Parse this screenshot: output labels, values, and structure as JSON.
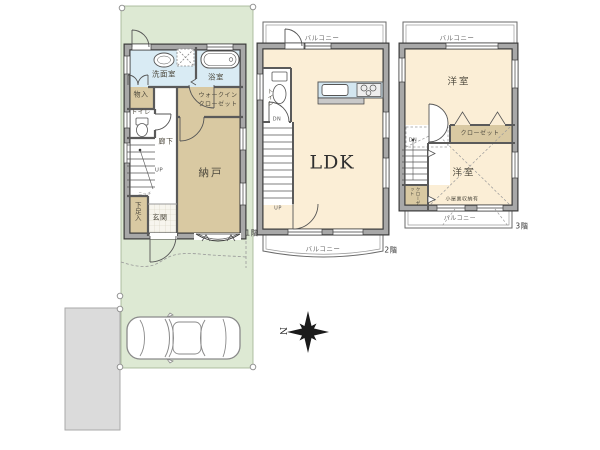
{
  "site": {
    "compass_label": "N"
  },
  "floor1": {
    "floor_tag": "1階",
    "washroom": "洗面室",
    "bathroom": "浴室",
    "storage_small": "物入",
    "toilet": "トイレ",
    "wic_line1": "ウォークイン",
    "wic_line2": "クローゼット",
    "hallway": "廊下",
    "stairs_up": "UP",
    "storeroom": "納戸",
    "niche": "ニッチ",
    "shoe_box": "下足入",
    "entrance": "玄関"
  },
  "floor2": {
    "floor_tag": "2階",
    "balcony_top": "バルコニー",
    "balcony_bottom": "バルコニー",
    "toilet": "トイレ",
    "stairs_down": "DN",
    "stairs_up": "UP",
    "ldk": "LDK"
  },
  "floor3": {
    "floor_tag": "3階",
    "balcony_top": "バルコニー",
    "balcony_bottom": "バルコニー",
    "room_top": "洋室",
    "closet": "クローゼット",
    "stairs_down": "DN",
    "room_bottom": "洋室",
    "attic_note": "小屋裏収納有",
    "closet_small": "クローゼット"
  },
  "colors": {
    "lot_green": "#dde9d3",
    "room_cream": "#fbeed6",
    "room_tan": "#d9c9a2",
    "wet_area_blue": "#d9ebf4",
    "wall_gray": "#a8a8a8",
    "wall_edge": "#3a3a3a",
    "neighbor_gray": "#dbdbdb"
  }
}
